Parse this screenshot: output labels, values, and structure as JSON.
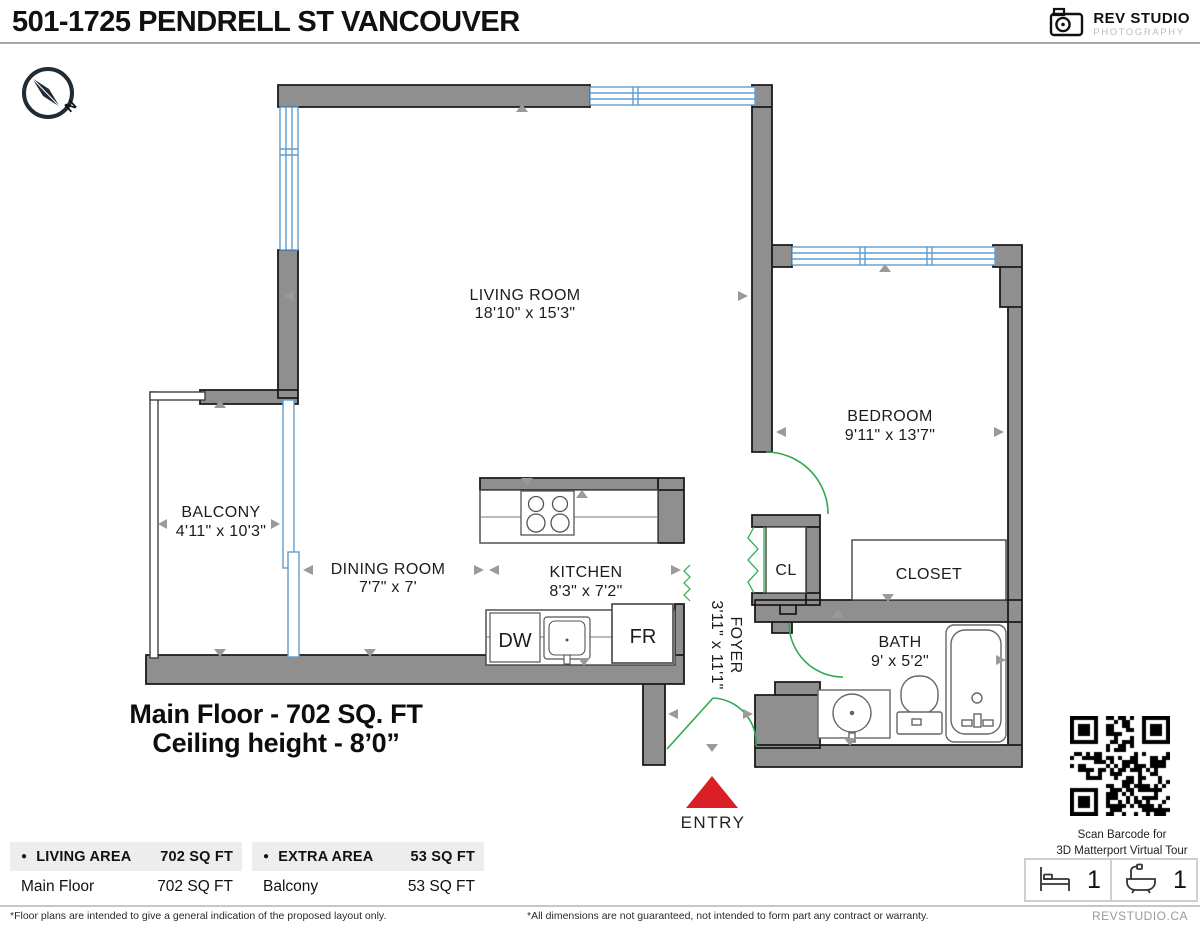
{
  "header": {
    "title": "501-1725 PENDRELL ST VANCOUVER",
    "logo": {
      "name": "REV STUDIO",
      "sub": "PHOTOGRAPHY"
    }
  },
  "compass": {
    "label": "N"
  },
  "floorplan": {
    "rooms": [
      {
        "id": "living",
        "name": "LIVING ROOM",
        "dims": "18'10\" x 15'3\""
      },
      {
        "id": "bedroom",
        "name": "BEDROOM",
        "dims": "9'11\" x 13'7\""
      },
      {
        "id": "balcony",
        "name": "BALCONY",
        "dims": "4'11\" x 10'3\""
      },
      {
        "id": "dining",
        "name": "DINING ROOM",
        "dims": "7'7\" x 7'"
      },
      {
        "id": "kitchen",
        "name": "KITCHEN",
        "dims": "8'3\" x 7'2\""
      },
      {
        "id": "foyer",
        "name": "FOYER",
        "dims": "3'11\" x 11'1\""
      },
      {
        "id": "bath",
        "name": "BATH",
        "dims": "9' x 5'2\""
      },
      {
        "id": "closet",
        "name": "CLOSET"
      },
      {
        "id": "cl",
        "name": "CL"
      }
    ],
    "appliances": {
      "dishwasher": "DW",
      "fridge": "FR"
    },
    "entry_label": "ENTRY",
    "floor_summary": {
      "line1": "Main Floor - 702 SQ. FT",
      "line2": "Ceiling height - 8’0”"
    },
    "colors": {
      "wall": "#8f8f8f",
      "window": "#5f9ccd",
      "door": "#2fa84f",
      "entry": "#da1f26",
      "arrow": "#9a9a9a"
    }
  },
  "qr": {
    "caption_line1": "Scan Barcode for",
    "caption_line2": "3D Matterport Virtual Tour"
  },
  "summary_tables": [
    {
      "header": {
        "label": "LIVING AREA",
        "value": "702 SQ FT"
      },
      "rows": [
        {
          "label": "Main Floor",
          "value": "702 SQ FT"
        }
      ]
    },
    {
      "header": {
        "label": "EXTRA AREA",
        "value": "53 SQ FT"
      },
      "rows": [
        {
          "label": "Balcony",
          "value": "53 SQ FT"
        }
      ]
    }
  ],
  "counts": {
    "beds": "1",
    "baths": "1"
  },
  "footer": {
    "disclaimer_left": "*Floor plans are intended to give a general indication of the proposed layout only.",
    "disclaimer_right": "*All dimensions are not guaranteed, not intended to form part any contract or warranty.",
    "website": "REVSTUDIO.CA"
  }
}
